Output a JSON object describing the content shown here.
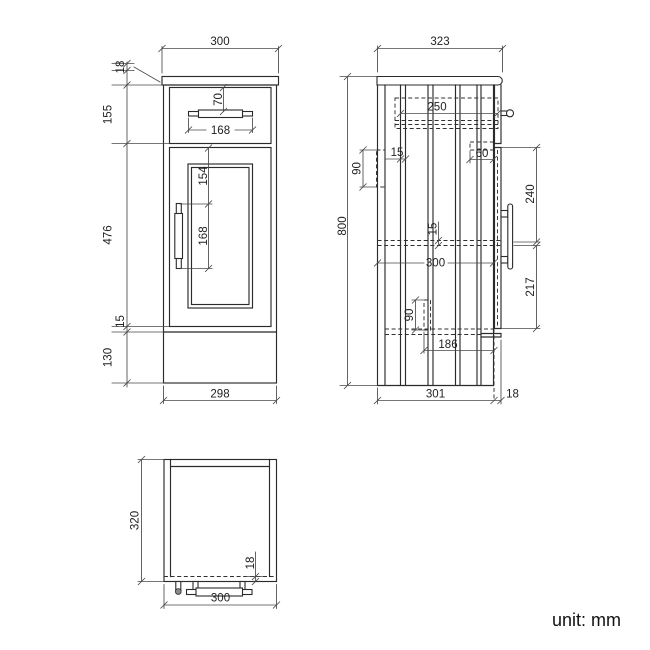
{
  "front_view": {
    "dims": {
      "width_top": "300",
      "worktop_thickness": "18",
      "drawer_front_height": "155",
      "door_height": "476",
      "door_bottom_gap": "15",
      "plinth_height": "130",
      "width_bottom": "298",
      "drawer_handle_offset": "70",
      "drawer_handle_length": "168",
      "door_handle_offset": "154",
      "door_handle_length": "168"
    }
  },
  "side_view": {
    "dims": {
      "depth_top": "323",
      "height_total": "800",
      "drawer_box_depth": "250",
      "back_rail_height": "90",
      "back_panel_thickness": "15",
      "runner_setback": "60",
      "handle_top_offset": "240",
      "handle_bottom_offset": "217",
      "bottom_panel_thickness": "15",
      "internal_depth": "300",
      "lower_rail_height": "90",
      "runner_length": "186",
      "carcass_depth": "301",
      "door_thickness": "18"
    }
  },
  "plan_view": {
    "dims": {
      "depth": "320",
      "front_panel_thickness": "18",
      "width": "300"
    }
  },
  "footer": {
    "unit_label": "unit: mm"
  }
}
